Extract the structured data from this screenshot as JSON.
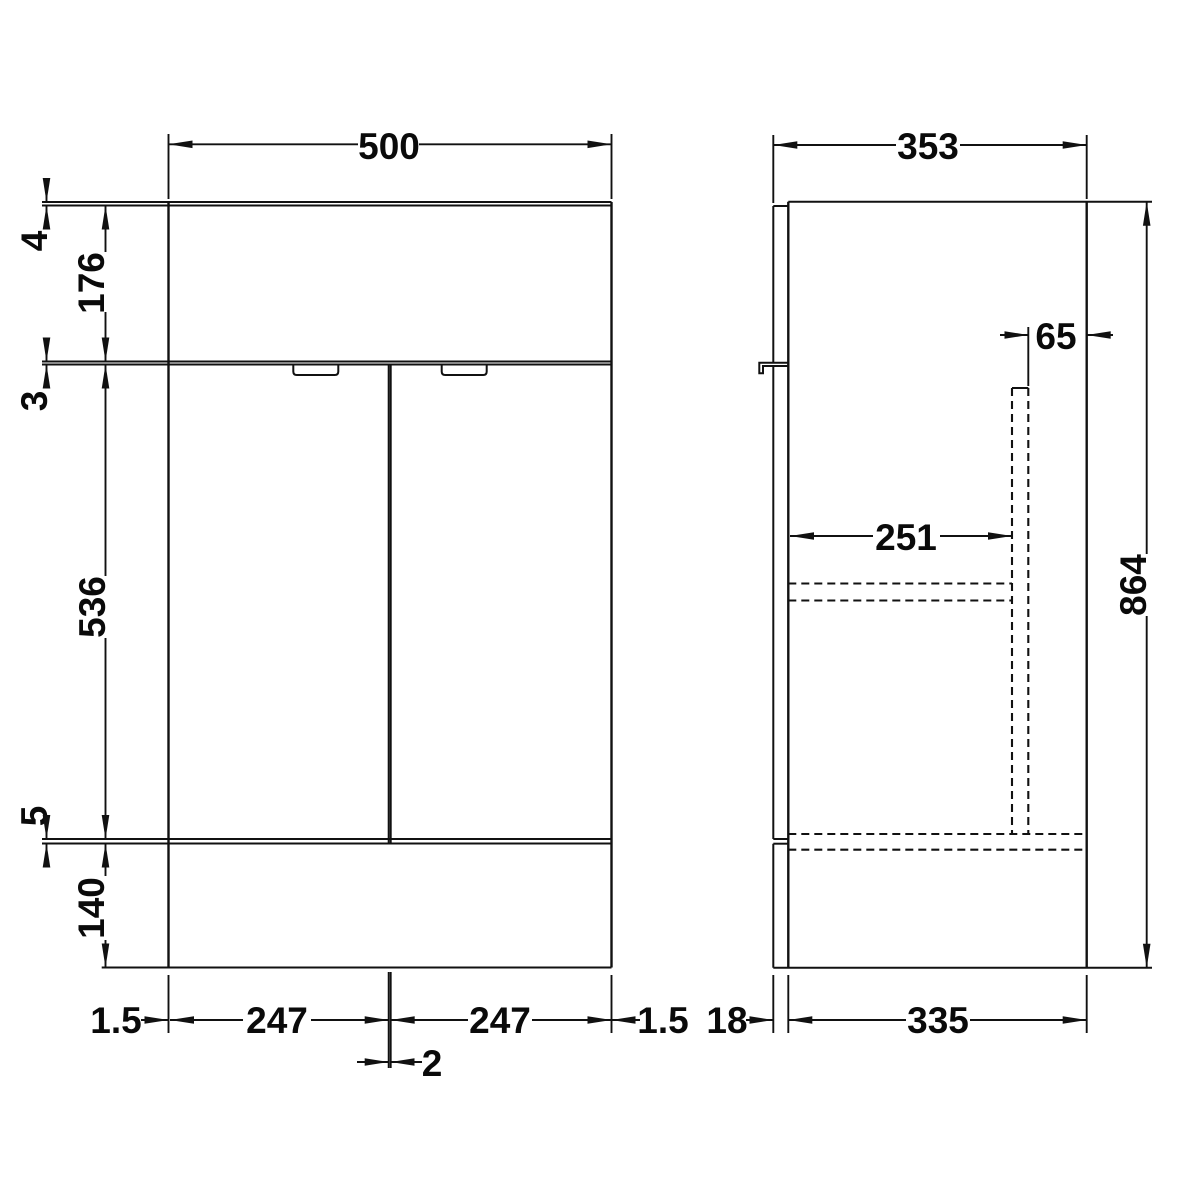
{
  "front_view": {
    "width": "500",
    "worktop_thickness": "4",
    "top_section_height": "176",
    "top_door_gap": "3",
    "door_height": "536",
    "bottom_door_gap": "5",
    "plinth_height": "140",
    "left_side_gap": "1.5",
    "left_door_width": "247",
    "right_door_width": "247",
    "right_side_gap": "1.5",
    "center_door_gap": "2"
  },
  "side_view": {
    "depth": "353",
    "back_recess": "65",
    "internal_shelf_depth": "251",
    "overall_height": "864",
    "front_panel_thickness": "18",
    "carcass_depth": "335"
  },
  "style": {
    "line_color": "#111111",
    "background": "#ffffff"
  }
}
